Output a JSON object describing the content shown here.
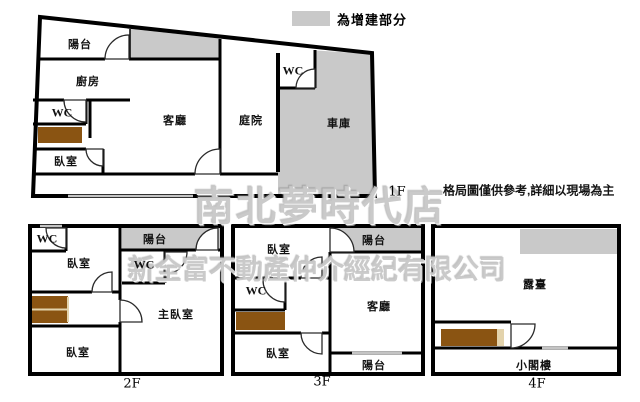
{
  "legend": {
    "label": "為增建部分",
    "swatch_color": "#c9c9c9"
  },
  "disclaimer": "格局圖僅供參考,詳細以現場為主",
  "watermarks": {
    "store": "南北夢時代店",
    "company": "新全富不動產仲介經紀有限公司"
  },
  "colors": {
    "addition_fill": "#c9c9c9",
    "stair_fill": "#8a5412",
    "stair_divider": "#e3d3ac",
    "wall": "#000000"
  },
  "floors": {
    "f1": {
      "label": "1F",
      "rooms": {
        "balcony": "陽台",
        "kitchen": "廚房",
        "wc_left": "WC",
        "bedroom": "臥室",
        "living_room": "客廳",
        "courtyard": "庭院",
        "wc_yard": "WC",
        "garage": "車庫"
      }
    },
    "f2": {
      "label": "2F",
      "rooms": {
        "wc_top": "WC",
        "bedroom_top": "臥室",
        "balcony": "陽台",
        "wc_mid": "WC",
        "master_bedroom": "主臥室",
        "bedroom_bottom": "臥室"
      }
    },
    "f3": {
      "label": "3F",
      "rooms": {
        "bedroom_top": "臥室",
        "balcony_top": "陽台",
        "wc": "WC",
        "living_room": "客廳",
        "bedroom_bottom": "臥室",
        "balcony_bottom": "陽台"
      }
    },
    "f4": {
      "label": "4F",
      "rooms": {
        "terrace": "露臺",
        "attic": "小閣樓"
      }
    }
  }
}
